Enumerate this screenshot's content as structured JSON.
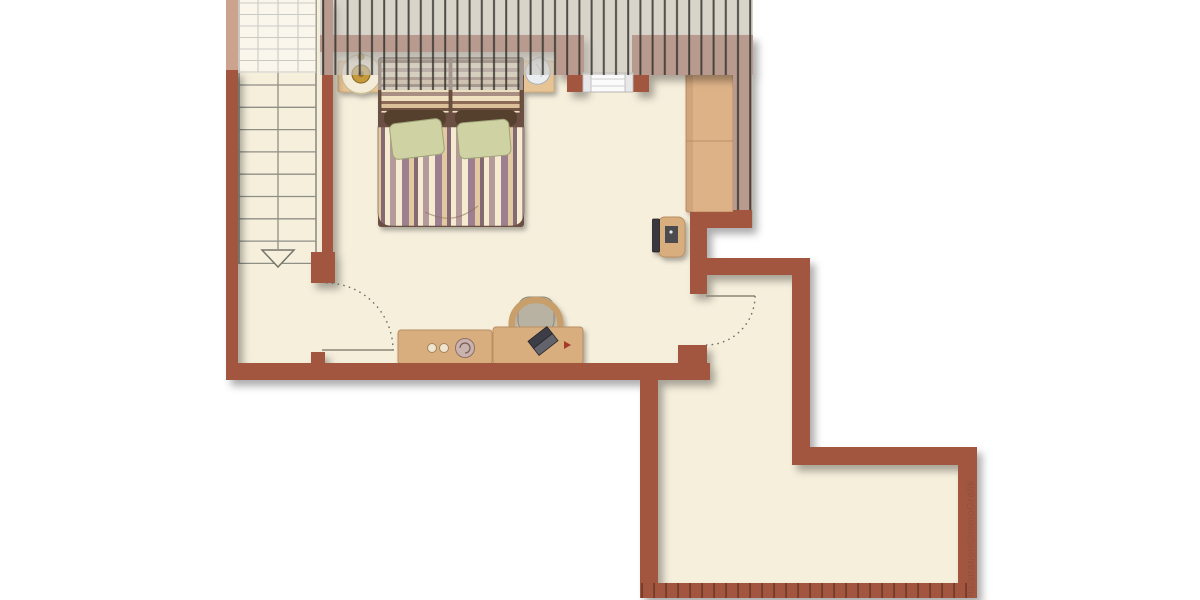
{
  "watermark": {
    "text": "Illustration©ImmoGrafik"
  },
  "palette": {
    "wall": "#a2573f",
    "wall_tick": "#6f3828",
    "floor": "#f6efdc",
    "roof_hatch_fill": "#c7c3be",
    "roof_hatch_line": "#322f2b",
    "wood_furniture": "#d9ae7e",
    "wood_shelf": "#e7c495",
    "wardrobe_wood": "#ddb287",
    "stair_line": "#8f8f86",
    "pillow_olive": "#cfd3a3",
    "bed_frame_dark": "#6a5043",
    "tv_screen": "#38383c",
    "watermark_color": "#8d5241",
    "background": "#ffffff"
  },
  "plan": {
    "type": "attic-floor-plan",
    "rooms": [
      {
        "name": "bedroom-with-sloped-roof"
      },
      {
        "name": "staircase-landing"
      },
      {
        "name": "adjoining-room-lower-right"
      }
    ],
    "furniture": [
      {
        "name": "double-bed-striped-duvet"
      },
      {
        "name": "headboard-shelf"
      },
      {
        "name": "wall-clock-gold"
      },
      {
        "name": "shell-decor"
      },
      {
        "name": "wardrobe-two-sections"
      },
      {
        "name": "tv-on-stand"
      },
      {
        "name": "sideboard-with-knobs"
      },
      {
        "name": "desk-with-laptop"
      },
      {
        "name": "desk-chair"
      },
      {
        "name": "staircase-down-arrow"
      },
      {
        "name": "window-north"
      },
      {
        "name": "door-bedroom"
      },
      {
        "name": "door-adjoining-room"
      }
    ]
  }
}
